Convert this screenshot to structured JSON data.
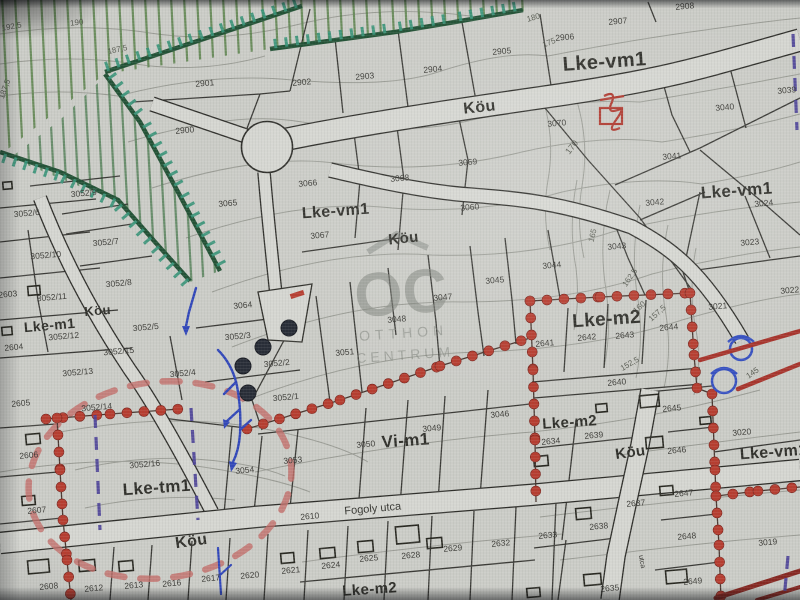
{
  "colors": {
    "paper": "#cbccc6",
    "road_fill": "#d7d8d2",
    "parcel_line": "#2d2d28",
    "contour_line": "#8e9189",
    "green_boundary": "#1e5233",
    "green_ticks": "#2f9678",
    "green_lines": "#4f7f3e",
    "red_dots": "#c0392b",
    "red_road": "#b03128",
    "dark_red_road": "#8e241e",
    "pink_dashed": "#c96b66",
    "blue_lines": "#2d46c4",
    "purple_dashed": "#4a3f9f",
    "watermark_gray": "#80847d"
  },
  "watermark": {
    "logo": "OC",
    "line1": "OTTHON",
    "line2": "CENTRUM"
  },
  "map": {
    "street_labels": [
      {
        "text": "Fogoly utca",
        "x": 373,
        "y": 512,
        "size": 11,
        "rot": -5
      },
      {
        "text": "utca",
        "x": 640,
        "y": 562,
        "size": 7,
        "rot": 80
      }
    ],
    "zone_labels": [
      {
        "text": "Lke-vm1",
        "x": 605,
        "y": 68,
        "size": 20,
        "rot": -4
      },
      {
        "text": "Lke-vm1",
        "x": 737,
        "y": 196,
        "size": 17,
        "rot": -4
      },
      {
        "text": "Lke-vm1",
        "x": 336,
        "y": 216,
        "size": 16,
        "rot": -4
      },
      {
        "text": "Lke-vm1",
        "x": 774,
        "y": 457,
        "size": 16,
        "rot": -4
      },
      {
        "text": "Köu",
        "x": 480,
        "y": 112,
        "size": 16,
        "rot": -6
      },
      {
        "text": "Köu",
        "x": 404,
        "y": 243,
        "size": 15,
        "rot": -6
      },
      {
        "text": "Köu",
        "x": 98,
        "y": 315,
        "size": 13,
        "rot": -5
      },
      {
        "text": "Köu",
        "x": 192,
        "y": 546,
        "size": 16,
        "rot": -8
      },
      {
        "text": "Köu",
        "x": 631,
        "y": 457,
        "size": 15,
        "rot": -8
      },
      {
        "text": "Lke-m1",
        "x": 50,
        "y": 330,
        "size": 14,
        "rot": -5
      },
      {
        "text": "Lke-m2",
        "x": 607,
        "y": 325,
        "size": 19,
        "rot": -4
      },
      {
        "text": "Lke-m2",
        "x": 570,
        "y": 427,
        "size": 15,
        "rot": -4
      },
      {
        "text": "Lke-m2",
        "x": 370,
        "y": 594,
        "size": 15,
        "rot": -4
      },
      {
        "text": "Lke-tm1",
        "x": 157,
        "y": 493,
        "size": 17,
        "rot": -4
      },
      {
        "text": "Vi-m1",
        "x": 406,
        "y": 446,
        "size": 17,
        "rot": -4
      }
    ],
    "contour_labels": [
      {
        "text": "192,5",
        "x": 12,
        "y": 29,
        "size": 8,
        "rot": -10
      },
      {
        "text": "190",
        "x": 77,
        "y": 25,
        "size": 8,
        "rot": -6
      },
      {
        "text": "187,5",
        "x": 118,
        "y": 52,
        "size": 8,
        "rot": -12
      },
      {
        "text": "187,5",
        "x": 7,
        "y": 90,
        "size": 8,
        "rot": -70
      },
      {
        "text": "180",
        "x": 534,
        "y": 20,
        "size": 8,
        "rot": -16
      },
      {
        "text": "175",
        "x": 550,
        "y": 45,
        "size": 8,
        "rot": -22
      },
      {
        "text": "170",
        "x": 574,
        "y": 149,
        "size": 9,
        "rot": -52
      },
      {
        "text": "165",
        "x": 595,
        "y": 236,
        "size": 8,
        "rot": -76
      },
      {
        "text": "162,5",
        "x": 632,
        "y": 279,
        "size": 8,
        "rot": -55
      },
      {
        "text": "160",
        "x": 641,
        "y": 309,
        "size": 8,
        "rot": -42
      },
      {
        "text": "157,5",
        "x": 659,
        "y": 315,
        "size": 8,
        "rot": -42
      },
      {
        "text": "152,5",
        "x": 631,
        "y": 366,
        "size": 8,
        "rot": -30
      },
      {
        "text": "145",
        "x": 754,
        "y": 375,
        "size": 8,
        "rot": -35
      }
    ],
    "parcel_labels": [
      {
        "text": "2901",
        "x": 205,
        "y": 86
      },
      {
        "text": "2900",
        "x": 185,
        "y": 133
      },
      {
        "text": "2902",
        "x": 302,
        "y": 85
      },
      {
        "text": "2903",
        "x": 365,
        "y": 79
      },
      {
        "text": "2904",
        "x": 433,
        "y": 72
      },
      {
        "text": "2905",
        "x": 502,
        "y": 54
      },
      {
        "text": "2906",
        "x": 565,
        "y": 40
      },
      {
        "text": "2907",
        "x": 618,
        "y": 24
      },
      {
        "text": "2908",
        "x": 685,
        "y": 9
      },
      {
        "text": "3039",
        "x": 787,
        "y": 93
      },
      {
        "text": "3040",
        "x": 725,
        "y": 110
      },
      {
        "text": "3070",
        "x": 557,
        "y": 126
      },
      {
        "text": "3041",
        "x": 672,
        "y": 159
      },
      {
        "text": "3066",
        "x": 308,
        "y": 186
      },
      {
        "text": "3068",
        "x": 400,
        "y": 181
      },
      {
        "text": "3065",
        "x": 228,
        "y": 206
      },
      {
        "text": "3067",
        "x": 320,
        "y": 238
      },
      {
        "text": "3069",
        "x": 468,
        "y": 165
      },
      {
        "text": "3060",
        "x": 470,
        "y": 210
      },
      {
        "text": "3042",
        "x": 655,
        "y": 205
      },
      {
        "text": "3024",
        "x": 764,
        "y": 206
      },
      {
        "text": "3043",
        "x": 617,
        "y": 249
      },
      {
        "text": "3023",
        "x": 750,
        "y": 245
      },
      {
        "text": "3044",
        "x": 552,
        "y": 268
      },
      {
        "text": "3022",
        "x": 790,
        "y": 293
      },
      {
        "text": "3021",
        "x": 718,
        "y": 309
      },
      {
        "text": "3045",
        "x": 495,
        "y": 283
      },
      {
        "text": "3047",
        "x": 443,
        "y": 300
      },
      {
        "text": "3048",
        "x": 397,
        "y": 322
      },
      {
        "text": "3051",
        "x": 345,
        "y": 355
      },
      {
        "text": "3064",
        "x": 243,
        "y": 308
      },
      {
        "text": "3052/3",
        "x": 238,
        "y": 339
      },
      {
        "text": "3052/2",
        "x": 277,
        "y": 366
      },
      {
        "text": "3052/1",
        "x": 286,
        "y": 400
      },
      {
        "text": "3046",
        "x": 500,
        "y": 417
      },
      {
        "text": "3049",
        "x": 432,
        "y": 431
      },
      {
        "text": "3050",
        "x": 366,
        "y": 447
      },
      {
        "text": "3053",
        "x": 293,
        "y": 463
      },
      {
        "text": "2610",
        "x": 310,
        "y": 519
      },
      {
        "text": "2640",
        "x": 617,
        "y": 385
      },
      {
        "text": "2641",
        "x": 545,
        "y": 346
      },
      {
        "text": "2642",
        "x": 587,
        "y": 340
      },
      {
        "text": "2643",
        "x": 625,
        "y": 338
      },
      {
        "text": "2644",
        "x": 669,
        "y": 330
      },
      {
        "text": "2645",
        "x": 672,
        "y": 411
      },
      {
        "text": "2646",
        "x": 677,
        "y": 453
      },
      {
        "text": "2647",
        "x": 684,
        "y": 496
      },
      {
        "text": "2648",
        "x": 687,
        "y": 539
      },
      {
        "text": "2649",
        "x": 693,
        "y": 584
      },
      {
        "text": "3020",
        "x": 742,
        "y": 435
      },
      {
        "text": "3019",
        "x": 768,
        "y": 545
      },
      {
        "text": "2634",
        "x": 551,
        "y": 444
      },
      {
        "text": "2639",
        "x": 594,
        "y": 438
      },
      {
        "text": "2637",
        "x": 636,
        "y": 506
      },
      {
        "text": "2638",
        "x": 599,
        "y": 529
      },
      {
        "text": "2633",
        "x": 548,
        "y": 538
      },
      {
        "text": "2635",
        "x": 610,
        "y": 591
      },
      {
        "text": "3054",
        "x": 245,
        "y": 473
      },
      {
        "text": "3052/16",
        "x": 145,
        "y": 467
      },
      {
        "text": "3052/14",
        "x": 97,
        "y": 410
      },
      {
        "text": "3052/13",
        "x": 78,
        "y": 375
      },
      {
        "text": "3052/4",
        "x": 183,
        "y": 376
      },
      {
        "text": "3052/10",
        "x": 46,
        "y": 258
      },
      {
        "text": "3052/7",
        "x": 106,
        "y": 245
      },
      {
        "text": "3052/9",
        "x": 84,
        "y": 196
      },
      {
        "text": "3052/6",
        "x": 27,
        "y": 216
      },
      {
        "text": "3052/8",
        "x": 119,
        "y": 286
      },
      {
        "text": "3052/11",
        "x": 52,
        "y": 300
      },
      {
        "text": "3052/12",
        "x": 64,
        "y": 339
      },
      {
        "text": "3052/5",
        "x": 146,
        "y": 330
      },
      {
        "text": "3052/15",
        "x": 119,
        "y": 354
      },
      {
        "text": "2604",
        "x": 14,
        "y": 350
      },
      {
        "text": "2603",
        "x": 8,
        "y": 297
      },
      {
        "text": "2605",
        "x": 21,
        "y": 406
      },
      {
        "text": "2606",
        "x": 29,
        "y": 458
      },
      {
        "text": "2607",
        "x": 37,
        "y": 513
      },
      {
        "text": "2608",
        "x": 49,
        "y": 589
      },
      {
        "text": "2612",
        "x": 94,
        "y": 591
      },
      {
        "text": "2613",
        "x": 134,
        "y": 588
      },
      {
        "text": "2616",
        "x": 172,
        "y": 586
      },
      {
        "text": "2617",
        "x": 211,
        "y": 581
      },
      {
        "text": "2620",
        "x": 250,
        "y": 578
      },
      {
        "text": "2621",
        "x": 291,
        "y": 573
      },
      {
        "text": "2624",
        "x": 331,
        "y": 568
      },
      {
        "text": "2625",
        "x": 369,
        "y": 561
      },
      {
        "text": "2628",
        "x": 411,
        "y": 558
      },
      {
        "text": "2629",
        "x": 453,
        "y": 551
      },
      {
        "text": "2632",
        "x": 501,
        "y": 546
      }
    ]
  }
}
